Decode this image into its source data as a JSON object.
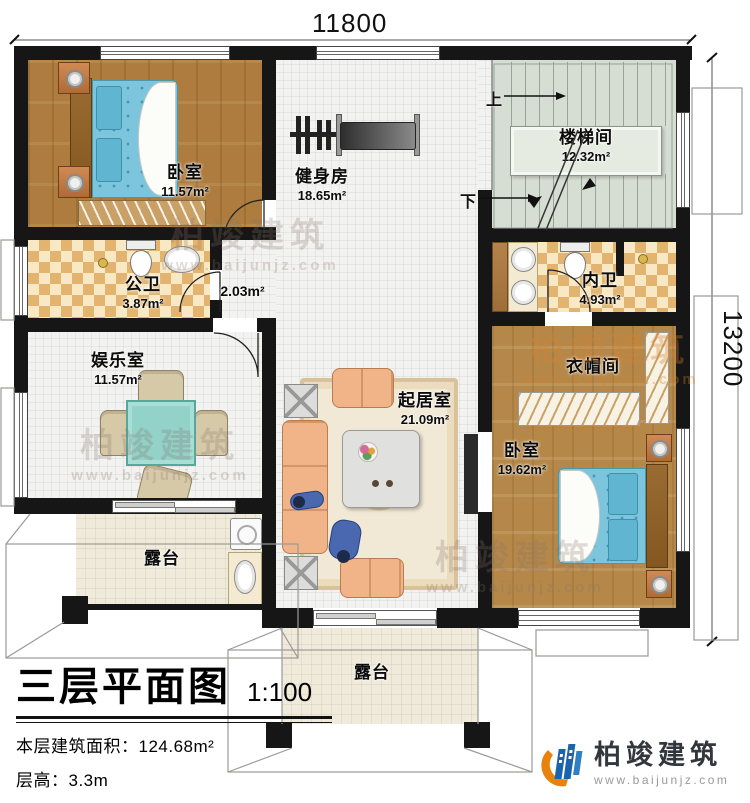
{
  "dimensions": {
    "top": "11800",
    "right": "13200"
  },
  "stairs": {
    "up": "上",
    "down": "下"
  },
  "rooms": {
    "bedroom1": {
      "name": "卧室",
      "area": "11.57m²"
    },
    "gym": {
      "name": "健身房",
      "area": "18.65m²"
    },
    "stairwell": {
      "name": "楼梯间",
      "area": "12.32m²"
    },
    "public_bath": {
      "name": "公卫",
      "area": "3.87m²"
    },
    "hall": {
      "area": "2.03m²"
    },
    "private_bath": {
      "name": "内卫",
      "area": "4.93m²"
    },
    "play_room": {
      "name": "娱乐室",
      "area": "11.57m²"
    },
    "living_room": {
      "name": "起居室",
      "area": "21.09m²"
    },
    "cloak_room": {
      "name": "衣帽间"
    },
    "bedroom2": {
      "name": "卧室",
      "area": "19.62m²"
    },
    "terrace_left": {
      "name": "露台"
    },
    "terrace_bottom": {
      "name": "露台"
    }
  },
  "title_block": {
    "title": "三层平面图",
    "scale": "1:100",
    "area_line": "本层建筑面积：124.68m²",
    "floor_height_line": "层高：3.3m",
    "note_line": "注：阳台算半面积，露台不算面积"
  },
  "logo": {
    "name": "柏竣建筑",
    "website": "www.baijunjz.com"
  },
  "watermark": {
    "text": "柏竣建筑",
    "subtext": "www.baijunjz.com"
  },
  "colors": {
    "wall": "#161616",
    "accent_blue": "#1c63ae",
    "accent_orange": "#e8820c",
    "bed": "#7cc5dc"
  }
}
